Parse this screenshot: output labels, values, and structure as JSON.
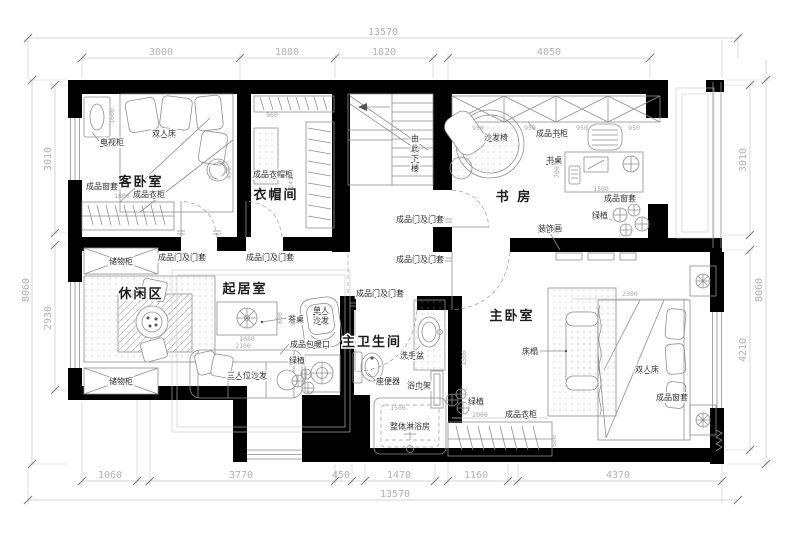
{
  "colors": {
    "wall": "#000000",
    "furniture_line": "#8f8f8f",
    "dim_line": "#c6c6c6",
    "dim_text": "#b2b2b2",
    "label_text": "#2e2e2e"
  },
  "rooms": [
    {
      "t": "客卧室",
      "x": 141,
      "y": 186,
      "n": "room-label-guest-bedroom"
    },
    {
      "t": "衣帽间",
      "x": 276,
      "y": 199,
      "n": "room-label-cloakroom"
    },
    {
      "t": "书 房",
      "x": 514,
      "y": 201,
      "n": "room-label-study"
    },
    {
      "t": "休闲区",
      "x": 141,
      "y": 298,
      "n": "room-label-leisure-area"
    },
    {
      "t": "起居室",
      "x": 245,
      "y": 293,
      "n": "room-label-living-room"
    },
    {
      "t": "主卫生间",
      "x": 372,
      "y": 346,
      "s": 12,
      "n": "room-label-master-bathroom"
    },
    {
      "t": "主卧室",
      "x": 512,
      "y": 320,
      "n": "room-label-master-bedroom"
    }
  ],
  "furniture_labels": [
    {
      "t": "双人床",
      "x": 152,
      "y": 136,
      "n": "label-double-bed-guest"
    },
    {
      "t": "电视柜",
      "x": 100,
      "y": 145,
      "n": "label-tv-cabinet"
    },
    {
      "t": "成品窗套",
      "x": 86,
      "y": 189,
      "n": "label-window-casing-guest"
    },
    {
      "t": "成品衣柜",
      "x": 133,
      "y": 197,
      "n": "label-wardrobe-guest"
    },
    {
      "t": "成品衣帽柜",
      "x": 253,
      "y": 177,
      "n": "label-cloak-cabinet"
    },
    {
      "t": "沙发椅",
      "x": 484,
      "y": 140,
      "n": "label-sofa-chair"
    },
    {
      "t": "成品书柜",
      "x": 536,
      "y": 136,
      "n": "label-bookcase"
    },
    {
      "t": "书桌",
      "x": 546,
      "y": 163,
      "n": "label-desk"
    },
    {
      "t": "成品窗套",
      "x": 604,
      "y": 201,
      "n": "label-window-casing-study"
    },
    {
      "t": "绿植",
      "x": 592,
      "y": 218,
      "n": "label-plant-study"
    },
    {
      "t": "装饰画",
      "x": 538,
      "y": 231,
      "n": "label-decor-painting"
    },
    {
      "t": "储物柜",
      "x": 121,
      "y": 264,
      "a": "middle",
      "n": "label-storage-top"
    },
    {
      "t": "储物柜",
      "x": 121,
      "y": 384,
      "a": "middle",
      "n": "label-storage-bottom"
    },
    {
      "t": "茶桌",
      "x": 288,
      "y": 322,
      "n": "label-tea-table"
    },
    {
      "t": "成品包暖口",
      "x": 290,
      "y": 347,
      "n": "label-radiator-cover"
    },
    {
      "t": "绿植",
      "x": 289,
      "y": 363,
      "n": "label-plant-living"
    },
    {
      "t": "三人位沙发",
      "x": 247,
      "y": 378,
      "a": "middle",
      "n": "label-three-seat-sofa"
    },
    {
      "t": "单人",
      "x": 313,
      "y": 313,
      "n": "label-single-sofa-1"
    },
    {
      "t": "沙发",
      "x": 313,
      "y": 323,
      "n": "label-single-sofa-2"
    },
    {
      "t": "洗手盆",
      "x": 400,
      "y": 358,
      "n": "label-wash-basin"
    },
    {
      "t": "座便器",
      "x": 376,
      "y": 384,
      "n": "label-toilet"
    },
    {
      "t": "浴巾架",
      "x": 407,
      "y": 388,
      "n": "label-towel-rack"
    },
    {
      "t": "整体淋浴房",
      "x": 410,
      "y": 429,
      "a": "middle",
      "n": "label-shower-cabin"
    },
    {
      "t": "绿植",
      "x": 468,
      "y": 404,
      "n": "label-plant-master"
    },
    {
      "t": "成品衣柜",
      "x": 505,
      "y": 417,
      "n": "label-wardrobe-master"
    },
    {
      "t": "成品窗套",
      "x": 656,
      "y": 400,
      "n": "label-window-casing-master"
    },
    {
      "t": "床榻",
      "x": 522,
      "y": 354,
      "n": "label-bed-bench"
    },
    {
      "t": "双人床",
      "x": 635,
      "y": 372,
      "n": "label-double-bed-master"
    },
    {
      "t": "由",
      "x": 415,
      "y": 141,
      "a": "middle",
      "s": 7,
      "n": "stair-note-char"
    },
    {
      "t": "此",
      "x": 415,
      "y": 151,
      "a": "middle",
      "s": 7,
      "n": "stair-note-char"
    },
    {
      "t": "下",
      "x": 415,
      "y": 161,
      "a": "middle",
      "s": 7,
      "n": "stair-note-char"
    },
    {
      "t": "楼",
      "x": 415,
      "y": 171,
      "a": "middle",
      "s": 7,
      "n": "stair-note-char"
    }
  ],
  "door_labels": [
    {
      "t": "成品门及门套",
      "x": 158,
      "y": 260,
      "n": "label-door-guest"
    },
    {
      "t": "成品门及门套",
      "x": 246,
      "y": 260,
      "n": "label-door-cloak"
    },
    {
      "t": "成品门及门套",
      "x": 396,
      "y": 222,
      "n": "label-door-study"
    },
    {
      "t": "成品门及门套",
      "x": 396,
      "y": 262,
      "n": "label-door-master"
    },
    {
      "t": "成品门及门套",
      "x": 356,
      "y": 296,
      "n": "label-door-bathroom"
    }
  ],
  "dims_outer": [
    {
      "t": "13570",
      "x": 383,
      "y": 35,
      "n": "dim-top-overall"
    },
    {
      "t": "3000",
      "x": 161,
      "y": 55
    },
    {
      "t": "1880",
      "x": 287,
      "y": 55
    },
    {
      "t": "1820",
      "x": 384,
      "y": 55
    },
    {
      "t": "4050",
      "x": 549,
      "y": 55
    },
    {
      "t": "1060",
      "x": 110,
      "y": 478
    },
    {
      "t": "3770",
      "x": 241,
      "y": 478
    },
    {
      "t": "450",
      "x": 341,
      "y": 478
    },
    {
      "t": "1470",
      "x": 399,
      "y": 478
    },
    {
      "t": "1160",
      "x": 476,
      "y": 478
    },
    {
      "t": "4370",
      "x": 618,
      "y": 478
    },
    {
      "t": "13570",
      "x": 395,
      "y": 497,
      "n": "dim-bottom-overall"
    },
    {
      "t": "3010",
      "x": 51,
      "y": 159,
      "r": -90
    },
    {
      "t": "2930",
      "x": 51,
      "y": 318,
      "r": -90
    },
    {
      "t": "8060",
      "x": 29,
      "y": 290,
      "r": -90
    },
    {
      "t": "3010",
      "x": 746,
      "y": 160,
      "r": -90
    },
    {
      "t": "4210",
      "x": 746,
      "y": 350,
      "r": -90
    },
    {
      "t": "8060",
      "x": 762,
      "y": 290,
      "r": -90
    }
  ],
  "dims_inner": [
    {
      "t": "1600",
      "x": 114,
      "y": 116,
      "r": -90
    },
    {
      "t": "1800",
      "x": 122,
      "y": 198
    },
    {
      "t": "450",
      "x": 231,
      "y": 173,
      "r": -90
    },
    {
      "t": "960",
      "x": 272,
      "y": 117
    },
    {
      "t": "2410",
      "x": 293,
      "y": 181,
      "r": -90
    },
    {
      "t": "950",
      "x": 478,
      "y": 130
    },
    {
      "t": "950",
      "x": 530,
      "y": 130
    },
    {
      "t": "950",
      "x": 582,
      "y": 130
    },
    {
      "t": "950",
      "x": 634,
      "y": 130
    },
    {
      "t": "700",
      "x": 559,
      "y": 172,
      "r": -90
    },
    {
      "t": "1500",
      "x": 601,
      "y": 191
    },
    {
      "t": "600",
      "x": 282,
      "y": 318,
      "r": -90
    },
    {
      "t": "1080",
      "x": 247,
      "y": 341
    },
    {
      "t": "2100",
      "x": 243,
      "y": 348
    },
    {
      "t": "900",
      "x": 295,
      "y": 320,
      "r": -90
    },
    {
      "t": "1500",
      "x": 466,
      "y": 358,
      "r": -90
    },
    {
      "t": "2300",
      "x": 630,
      "y": 296
    },
    {
      "t": "2000",
      "x": 480,
      "y": 417
    },
    {
      "t": "1500",
      "x": 398,
      "y": 410
    },
    {
      "t": "600",
      "x": 556,
      "y": 441,
      "r": -90
    }
  ]
}
